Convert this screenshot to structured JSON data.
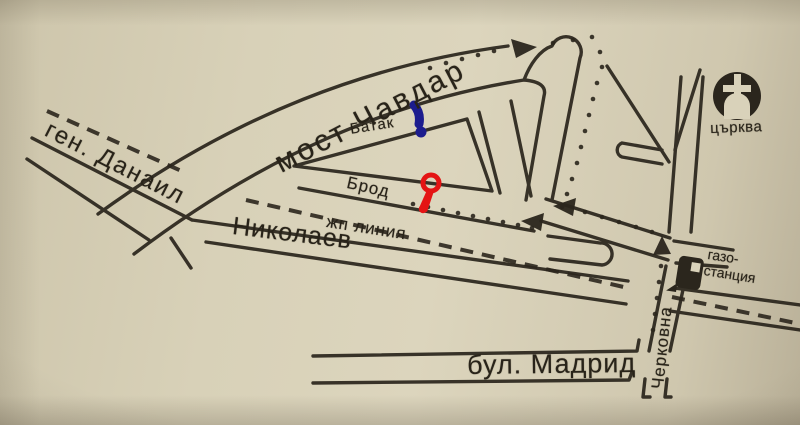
{
  "labels": {
    "most_chavdar": "мост Чавдар",
    "gen_danail": "ген. Данаил",
    "batak": "Батак",
    "brod": "Брод",
    "zhp_linia": "жп линия",
    "nikolaev": "Николаев",
    "bul_madrid": "бул. Мадрид",
    "cherkovna": "Черковна",
    "church": "църква",
    "gas_line1": "газо-",
    "gas_line2": "станция"
  },
  "icons": {
    "church": "church-icon",
    "gas_station": "gas-station-icon",
    "direction_arrows": "arrow-icon"
  },
  "markers": {
    "blue": {
      "label": "blue-location-marker",
      "color": "#1c1c8e"
    },
    "red": {
      "label": "red-pin-marker",
      "color": "#e41414"
    }
  },
  "colors": {
    "background": "#d4ccb3",
    "line": "#2b261d",
    "text": "#282319"
  }
}
